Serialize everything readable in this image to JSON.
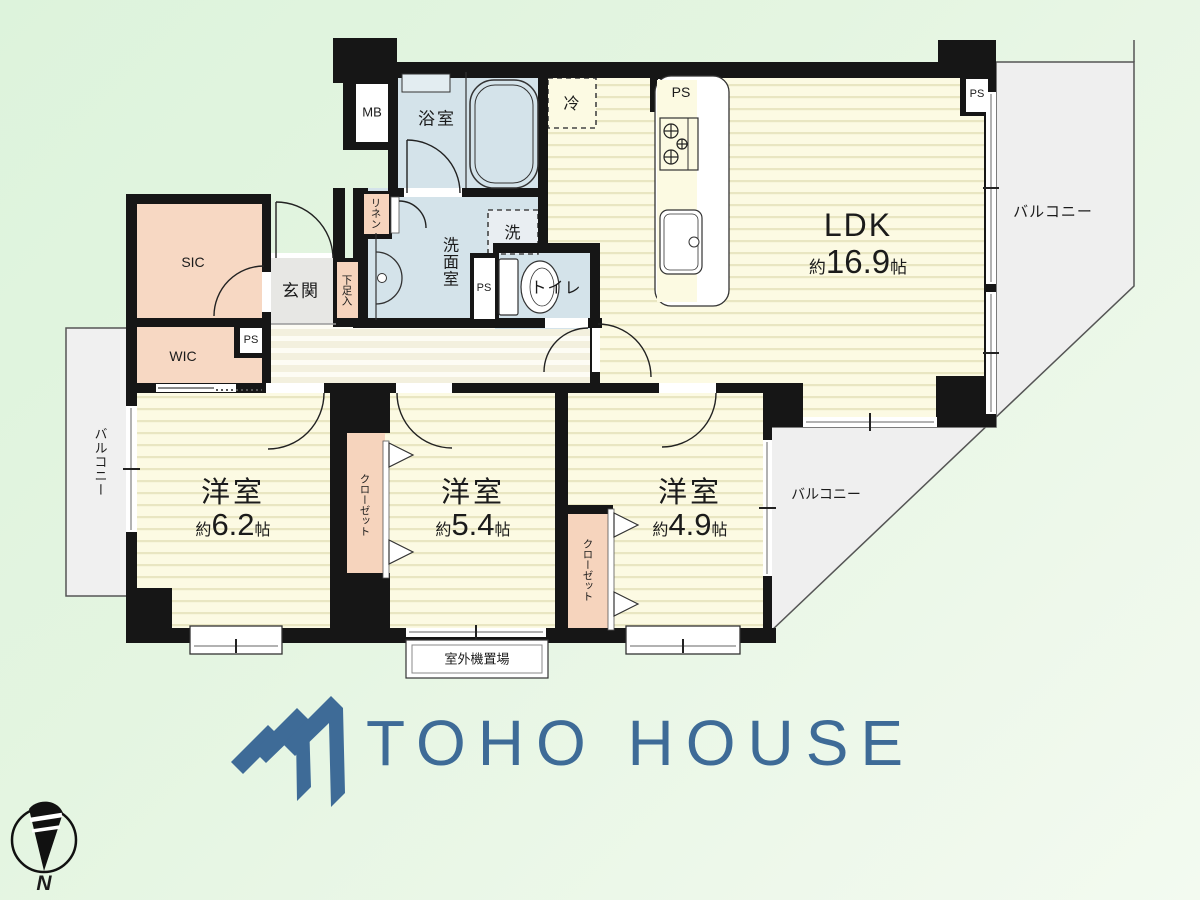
{
  "logo": {
    "text": "TOHO HOUSE",
    "color": "#3e6b97"
  },
  "compass": {
    "label": "N"
  },
  "rooms": {
    "ldk": {
      "name": "LDK",
      "approx": "約",
      "size": "16.9",
      "unit": "帖"
    },
    "bedroom1": {
      "name": "洋室",
      "approx": "約",
      "size": "6.2",
      "unit": "帖"
    },
    "bedroom2": {
      "name": "洋室",
      "approx": "約",
      "size": "5.4",
      "unit": "帖"
    },
    "bedroom3": {
      "name": "洋室",
      "approx": "約",
      "size": "4.9",
      "unit": "帖"
    },
    "bathroom": "浴室",
    "washroom": "洗面室",
    "toilet": "トイレ",
    "entrance": "玄関",
    "sic": "SIC",
    "wic": "WIC",
    "balcony": "バルコニー",
    "closet": "クローゼット",
    "linen": "リネン",
    "shoe_cabinet": "下足入",
    "meter_box": "MB",
    "pipe_space": "PS",
    "refrigerator": "冷",
    "washer": "洗",
    "outdoor_unit": "室外機置場"
  },
  "colors": {
    "background_green": "#e0f4de",
    "room_yellow": "#fcfae3",
    "room_yellow_stripe": "#e9e6c2",
    "corridor_beige": "#f4f1e1",
    "wet_area_blue": "#d4e3ea",
    "closet_pink": "#f6d4bd",
    "entrance_gray": "#e7e7e4",
    "balcony_gray": "#efefef",
    "wall_black": "#161616",
    "logo_blue": "#3e6b97"
  }
}
